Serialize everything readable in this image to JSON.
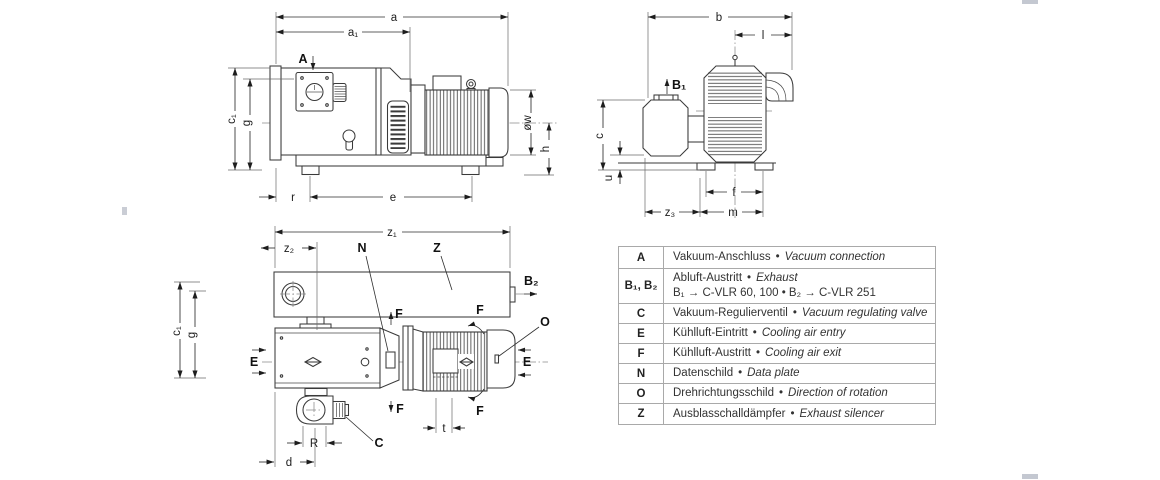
{
  "figure": {
    "dims": {
      "a": "a",
      "a1": "a₁",
      "b": "b",
      "l": "l",
      "c": "c",
      "u": "u",
      "z1": "z₁",
      "z2": "z₂",
      "z3": "z₃",
      "f": "f",
      "m": "m",
      "e": "e",
      "r": "r",
      "h": "h",
      "ow": "øw",
      "g": "g",
      "c1": "c₁",
      "R": "R",
      "d": "d",
      "t": "t"
    },
    "points": {
      "A": "A",
      "B1": "B₁",
      "B2": "B₂",
      "C": "C",
      "E": "E",
      "F": "F",
      "N": "N",
      "O": "O",
      "Z": "Z"
    }
  },
  "legend": {
    "sep": "•",
    "rows": [
      {
        "key": "A",
        "de": "Vakuum-Anschluss",
        "en": "Vacuum connection"
      },
      {
        "key": "B₁, B₂",
        "de": "Abluft-Austritt",
        "en": "Exhaust",
        "note": "B₁ → C-VLR 60, 100  •  B₂ → C-VLR 251"
      },
      {
        "key": "C",
        "de": "Vakuum-Regulierventil",
        "en": "Vacuum regulating valve"
      },
      {
        "key": "E",
        "de": "Kühlluft-Eintritt",
        "en": "Cooling air entry"
      },
      {
        "key": "F",
        "de": "Kühlluft-Austritt",
        "en": "Cooling air exit"
      },
      {
        "key": "N",
        "de": "Datenschild",
        "en": "Data plate"
      },
      {
        "key": "O",
        "de": "Drehrichtungsschild",
        "en": "Direction of rotation"
      },
      {
        "key": "Z",
        "de": "Ausblasschalldämpfer",
        "en": "Exhaust silencer"
      }
    ]
  }
}
